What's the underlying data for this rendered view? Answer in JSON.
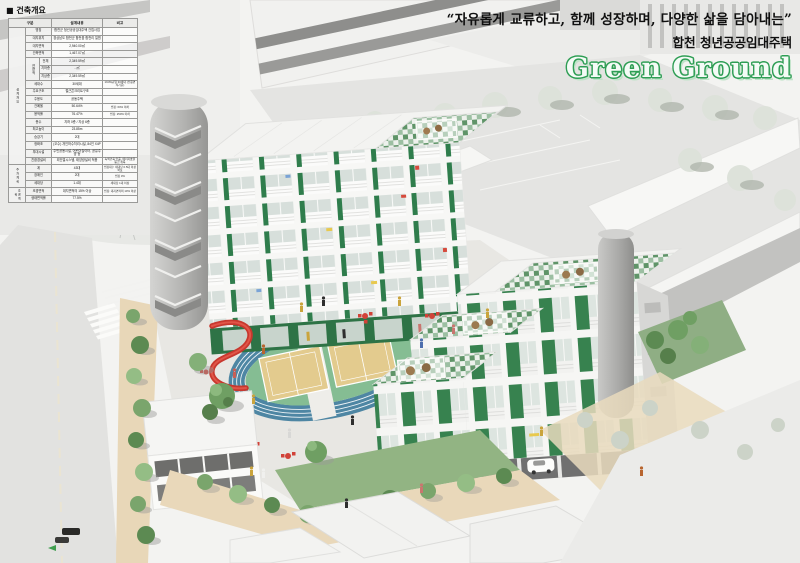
{
  "title": {
    "slogan": "“자유롭게 교류하고, 함께 성장하며, 다양한 삶을 담아내는”",
    "project": "합천 청년공공임대주택",
    "brand": "Green Ground",
    "brand_color": "#2f9e55"
  },
  "overview_table": {
    "heading": "■ 건축개요",
    "columns": [
      "구분",
      "설계내용",
      "비고"
    ],
    "rows": [
      {
        "group": "설계개요",
        "group_span": 18,
        "label": "명칭",
        "value": "합천군 청년공공임대주택 건립사업",
        "note": ""
      },
      {
        "label": "대지위치",
        "value": "경상남도 합천군 합천읍 합천리 일원",
        "note": ""
      },
      {
        "label": "대지면적",
        "value": "2,940.00㎡",
        "note": ""
      },
      {
        "label": "건축면적",
        "value": "1,467.07㎡",
        "note": ""
      },
      {
        "label": "연면적",
        "label_span": 3,
        "sub": "전체",
        "value": "2,349.59㎡",
        "note": ""
      },
      {
        "sub": "지하층",
        "value": "- ㎡",
        "note": ""
      },
      {
        "sub": "지상층",
        "value": "2,349.59㎡",
        "note": ""
      },
      {
        "label": "세대수",
        "value": "30세대",
        "note": "19.80㎡형 30세대 (전용면적기준)"
      },
      {
        "label": "주요구조",
        "value": "철근콘크리트구조",
        "note": ""
      },
      {
        "label": "주용도",
        "value": "공동주택",
        "note": ""
      },
      {
        "label": "건폐율",
        "value": "50.64%",
        "note": "법정: 60% 이하"
      },
      {
        "label": "용적률",
        "value": "76.47%",
        "note": "법정: 250% 이하"
      },
      {
        "label": "층수",
        "value": "지하 0층 / 지상 6층",
        "note": ""
      },
      {
        "label": "최고높이",
        "value": "23.85m",
        "note": ""
      },
      {
        "label": "승강기",
        "value": "2대",
        "note": ""
      },
      {
        "label": "정화조",
        "value": "(오수) 개인하수처리시설, 84인 X4P",
        "note": ""
      },
      {
        "label": "부대시설",
        "value": "주민공동시설, 어린이놀이터, 공유주방 등",
        "note": ""
      },
      {
        "label": "친환경설비",
        "value": "외단열시스템, 태양광설비 적용",
        "note": "녹색건축 인증, 에너지효율등급 취득"
      },
      {
        "group": "주차계획",
        "group_span": 3,
        "label": "계",
        "value": "43대",
        "note": "법정대수 세대당 0.5대 이상 확보"
      },
      {
        "label": "장애인",
        "value": "2대",
        "note": "법정 3%"
      },
      {
        "label": "세대당",
        "value": "1.4대",
        "note": "세대당 1대 이상"
      },
      {
        "group": "조경계획",
        "group_span": 2,
        "label": "조경면적",
        "value": "대지면적의 15% 이상",
        "note": "법정: 대지면적의 10% 이상"
      },
      {
        "label": "생태면적률",
        "value": "77.5%",
        "note": ""
      }
    ]
  },
  "scene": {
    "accent_green": "#2f7d4c",
    "panel_green": "#37824f",
    "track_blue": "#4e86a3",
    "infield_green": "#85bd93",
    "court_tan": "#e3cb8e",
    "furniture_red": "#c8382e",
    "context_gray": "#e6e6e4",
    "paper": "#f3f3f1"
  }
}
